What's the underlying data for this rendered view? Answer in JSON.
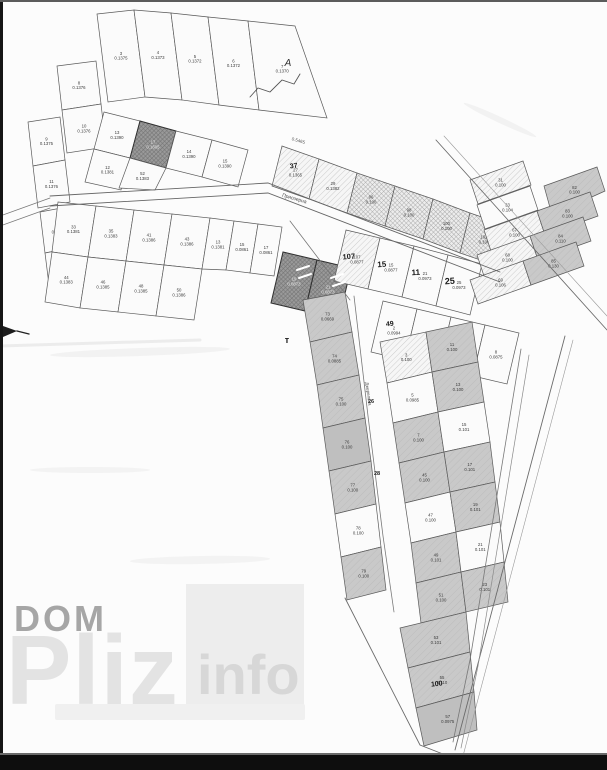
{
  "watermark": {
    "line1": "DOM",
    "line2": "Pliz",
    "line3": "info"
  },
  "map": {
    "street_main": "Приозерна",
    "street_side": "Джерельна",
    "junction_label": "А",
    "area_note": "0.5465",
    "t_mark": "т",
    "plot_font_size": 4.3,
    "colors": {
      "stroke": "#5a5a5a",
      "dark_stroke": "#2f2f2f",
      "label": "#3c3c3c",
      "label_dark": "#e8e8e8",
      "white": "#fbfbfb",
      "gray": "#c9c9c9",
      "gray2": "#bfbfbf"
    },
    "plots": [
      {
        "p": "97,14 134,10 145,97 108,102",
        "f": "w",
        "n": "3",
        "a": "0.1375"
      },
      {
        "p": "134,10 171,13 182,100 145,97",
        "f": "w",
        "n": "4",
        "a": "0.1373"
      },
      {
        "p": "171,13 208,17 219,105 182,100",
        "f": "w",
        "n": "5",
        "a": "0.1372"
      },
      {
        "p": "208,17 248,21 259,110 219,105",
        "f": "w",
        "n": "6",
        "a": "0.1372"
      },
      {
        "p": "248,21 295,26 327,118 259,110",
        "f": "w",
        "n": "7",
        "a": "0.1370"
      },
      {
        "p": "57,66 96,61 101,104 62,110",
        "f": "w",
        "n": "8",
        "a": "0.1376"
      },
      {
        "p": "62,110 101,104 106,147 67,153",
        "f": "w",
        "n": "10",
        "a": "0.1376"
      },
      {
        "p": "28,122 60,117 65,160 33,166",
        "f": "w",
        "n": "9",
        "a": "0.1375"
      },
      {
        "p": "33,166 65,160 70,202 38,208",
        "f": "w",
        "n": "11",
        "a": "0.1376"
      },
      {
        "p": "40,212 72,206 76,247 45,253",
        "f": "w",
        "n": "2",
        "a": "0.1379"
      },
      {
        "p": "45,253 76,247 80,287 50,293",
        "f": "w",
        "n": "4",
        "a": "0.1382"
      },
      {
        "p": "104,112 140,121 130,158 94,149",
        "f": "w",
        "n": "13",
        "a": "0.1390"
      },
      {
        "p": "140,121 176,131 166,168 130,158",
        "f": "d",
        "n": "17",
        "a": "0.1605"
      },
      {
        "p": "176,131 212,140 202,177 166,168",
        "f": "w",
        "n": "14",
        "a": "0.1390"
      },
      {
        "p": "212,140 248,150 238,187 202,177",
        "f": "w",
        "n": "15",
        "a": "0.1390"
      },
      {
        "p": "94,149 130,158 121,190 85,182",
        "f": "w",
        "n": "12",
        "a": "0.1381"
      },
      {
        "p": "130,158 166,168 155,190 119,188",
        "f": "w",
        "n": "52",
        "a": "0.1383"
      },
      {
        "p": "58,202 96,206 88,257 52,252",
        "f": "w",
        "n": "33",
        "a": "0.1381"
      },
      {
        "p": "96,206 134,210 126,261 88,257",
        "f": "w",
        "n": "35",
        "a": "0.1383"
      },
      {
        "p": "134,210 172,214 164,265 126,261",
        "f": "w",
        "n": "41",
        "a": "0.1386"
      },
      {
        "p": "172,214 210,218 202,269 164,265",
        "f": "w",
        "n": "43",
        "a": "0.1386"
      },
      {
        "p": "210,218 234,221 226,270 202,269",
        "f": "w",
        "n": "13",
        "a": "0.1381"
      },
      {
        "p": "234,221 258,224 250,273 226,270",
        "f": "w",
        "n": "15",
        "a": "0.0861"
      },
      {
        "p": "258,224 282,227 274,276 250,273",
        "f": "w",
        "n": "17",
        "a": "0.0861"
      },
      {
        "p": "52,252 88,257 80,308 45,302",
        "f": "w",
        "n": "44",
        "a": "0.1383"
      },
      {
        "p": "88,257 126,261 118,312 80,308",
        "f": "w",
        "n": "46",
        "a": "0.1385"
      },
      {
        "p": "126,261 164,265 156,316 118,312",
        "f": "w",
        "n": "48",
        "a": "0.1385"
      },
      {
        "p": "164,265 202,269 194,320 156,316",
        "f": "w",
        "n": "50",
        "a": "0.1386"
      },
      {
        "p": "282,146 319,159 309,199 272,186",
        "f": "hl",
        "n": "27",
        "a": "0.1365"
      },
      {
        "p": "319,159 357,173 347,213 309,199",
        "f": "hl",
        "n": "29",
        "a": "0.1382"
      },
      {
        "p": "357,173 395,186 385,226 347,213",
        "f": "hh",
        "n": "96",
        "a": "0.100"
      },
      {
        "p": "395,186 433,199 423,239 385,226",
        "f": "hh",
        "n": "98",
        "a": "0.100"
      },
      {
        "p": "433,199 470,213 460,253 423,239",
        "f": "hh",
        "n": "100",
        "a": "0.100"
      },
      {
        "p": "470,213 508,226 498,266 460,253",
        "f": "hh",
        "n": "102",
        "a": "0.100"
      },
      {
        "p": "283,252 317,260 305,311 271,303",
        "f": "d",
        "n": "19",
        "a": "0.0873"
      },
      {
        "p": "317,260 351,268 339,319 305,311",
        "f": "d",
        "n": "21",
        "a": "0.0873"
      },
      {
        "p": "346,230 380,238 368,289 334,281",
        "f": "hl",
        "n": "107",
        "a": "0.0877"
      },
      {
        "p": "380,238 414,246 402,297 368,289",
        "f": "w",
        "n": "15",
        "a": "0.0877"
      },
      {
        "p": "414,246 448,255 436,306 402,297",
        "f": "w",
        "n": "21",
        "a": "0.0973"
      },
      {
        "p": "448,255 482,264 470,315 436,306",
        "f": "w",
        "n": "25",
        "a": "0.0973"
      },
      {
        "p": "383,301 417,309 405,360 371,352",
        "f": "w",
        "n": "2",
        "a": "0.0994"
      },
      {
        "p": "417,309 451,317 439,368 405,360",
        "f": "w",
        "n": "4",
        "a": "0.0989"
      },
      {
        "p": "451,317 485,325 473,376 439,368",
        "f": "w",
        "n": "6",
        "a": "0.0875"
      },
      {
        "p": "485,325 519,333 507,384 473,376",
        "f": "w",
        "n": "8",
        "a": "0.0875"
      },
      {
        "p": "470,180 523,161 531,185 478,204",
        "f": "hl",
        "n": "31",
        "a": "0.100"
      },
      {
        "p": "477,205 530,186 538,210 485,229",
        "f": "w",
        "n": "33",
        "a": "0.104"
      },
      {
        "p": "484,230 537,211 545,235 492,254",
        "f": "hl",
        "n": "67",
        "a": "0.100"
      },
      {
        "p": "477,255 530,236 538,260 485,279",
        "f": "hl",
        "n": "68",
        "a": "0.100"
      },
      {
        "p": "470,280 523,261 531,285 478,304",
        "f": "hl",
        "n": "69",
        "a": "0.106"
      },
      {
        "p": "544,186 597,167 605,191 552,215",
        "f": "g",
        "n": "82",
        "a": "0.100"
      },
      {
        "p": "537,211 590,192 598,216 545,235",
        "f": "g",
        "n": "83",
        "a": "0.100"
      },
      {
        "p": "530,236 583,217 591,241 538,260",
        "f": "g",
        "n": "84",
        "a": "0.110"
      },
      {
        "p": "523,261 576,242 584,266 531,285",
        "f": "g",
        "n": "85",
        "a": "0.130"
      },
      {
        "p": "303,300 345,292 352,332 310,342",
        "f": "g",
        "n": "73",
        "a": "0.0669"
      },
      {
        "p": "310,342 352,332 359,375 317,385",
        "f": "g",
        "n": "74",
        "a": "0.0885"
      },
      {
        "p": "317,385 359,375 365,418 323,428",
        "f": "g",
        "n": "75",
        "a": "0.100"
      },
      {
        "p": "323,428 365,418 371,461 329,471",
        "f": "g2",
        "n": "76",
        "a": "0.100"
      },
      {
        "p": "329,471 371,461 376,504 335,514",
        "f": "g",
        "n": "77",
        "a": "0.100"
      },
      {
        "p": "335,514 376,504 381,547 341,557",
        "f": "w",
        "n": "78",
        "a": "0.100"
      },
      {
        "p": "341,557 381,547 386,590 347,600",
        "f": "g",
        "n": "79",
        "a": "0.100"
      },
      {
        "p": "380,342 426,332 432,372 387,383",
        "f": "hl",
        "n": "3",
        "a": "0.100"
      },
      {
        "p": "387,383 432,372 438,412 393,423",
        "f": "w",
        "n": "5",
        "a": "0.0985"
      },
      {
        "p": "393,423 438,412 444,452 399,463",
        "f": "g",
        "n": "7",
        "a": "0.100"
      },
      {
        "p": "399,463 444,452 450,492 405,503",
        "f": "g",
        "n": "45",
        "a": "0.100"
      },
      {
        "p": "405,503 450,492 456,532 411,543",
        "f": "w",
        "n": "47",
        "a": "0.100"
      },
      {
        "p": "411,543 456,532 461,572 416,583",
        "f": "g",
        "n": "49",
        "a": "0.101"
      },
      {
        "p": "416,583 461,572 466,612 421,623",
        "f": "g",
        "n": "51",
        "a": "0.100"
      },
      {
        "p": "426,332 472,322 478,362 432,372",
        "f": "g",
        "n": "11",
        "a": "0.100"
      },
      {
        "p": "432,372 478,362 484,402 438,412",
        "f": "g",
        "n": "13",
        "a": "0.100"
      },
      {
        "p": "438,412 484,402 490,442 444,452",
        "f": "w",
        "n": "15",
        "a": "0.101"
      },
      {
        "p": "444,452 490,442 495,482 450,492",
        "f": "g",
        "n": "17",
        "a": "0.101"
      },
      {
        "p": "450,492 495,482 500,522 456,532",
        "f": "g",
        "n": "19",
        "a": "0.101"
      },
      {
        "p": "456,532 500,522 504,562 461,572",
        "f": "w",
        "n": "21",
        "a": "0.101"
      },
      {
        "p": "461,572 504,562 508,602 466,612",
        "f": "g",
        "n": "23",
        "a": "0.101"
      },
      {
        "p": "400,628 466,612 470,652 408,668",
        "f": "g",
        "n": "53",
        "a": "0.101"
      },
      {
        "p": "408,668 470,652 474,692 416,708",
        "f": "g",
        "n": "55",
        "a": "0.110"
      },
      {
        "p": "416,708 474,692 477,730 424,746",
        "f": "g2",
        "n": "57",
        "a": "0.0975"
      }
    ],
    "arrow": "3,326 17,331 3,337",
    "lines": [
      {
        "p": "50,196 268,183 500,272",
        "w": 0.9,
        "c": "#666666"
      },
      {
        "p": "50,206 268,193 500,282",
        "w": 0.9,
        "c": "#666666"
      },
      {
        "p": "0,216 50,198",
        "w": 0.8,
        "c": "#777777"
      },
      {
        "p": "0,226 50,208",
        "w": 0.8,
        "c": "#777777"
      },
      {
        "p": "436,140 607,330",
        "w": 0.9,
        "c": "#6b6b6b"
      },
      {
        "p": "444,136 607,316",
        "w": 0.6,
        "c": "#9a9a9a"
      },
      {
        "p": "345,598 420,745 448,756",
        "w": 0.9,
        "c": "#6b6b6b"
      },
      {
        "p": "565,336 455,750",
        "w": 0.9,
        "c": "#6b6b6b"
      },
      {
        "p": "573,340 463,756",
        "w": 0.6,
        "c": "#9a9a9a"
      },
      {
        "p": "354,296 368,416 383,536 394,612",
        "w": 0.8,
        "c": "#787878"
      },
      {
        "p": "521,349 470,660 453,742",
        "w": 0.8,
        "c": "#787878"
      },
      {
        "p": "529,355 478,666 461,748",
        "w": 0.7,
        "c": "#8a8a8a"
      },
      {
        "p": "290,221 350,300",
        "w": 0.8,
        "c": "#777777"
      },
      {
        "p": "250,97 258,88 270,92 282,80 294,84 300,74",
        "w": 0.9,
        "c": "#555555"
      },
      {
        "p": "297,270 309,266",
        "w": 2,
        "c": "#ffffff"
      },
      {
        "p": "299,278 311,274",
        "w": 2,
        "c": "#ffffff"
      },
      {
        "p": "331,278 343,274",
        "w": 2,
        "c": "#ffffff"
      },
      {
        "p": "333,286 345,282",
        "w": 2,
        "c": "#ffffff"
      },
      {
        "p": "0,346 200,340",
        "w": 3,
        "c": "#ececec"
      },
      {
        "p": "17,331 29,334",
        "w": 1.4,
        "c": "#222222"
      }
    ],
    "labels": [
      {
        "x": 288,
        "y": 66,
        "t": "А",
        "fs": 10,
        "rot": 0,
        "c": "#333333",
        "b": 0,
        "i": 1
      },
      {
        "x": 298,
        "y": 142,
        "t": "0.5465",
        "fs": 4.5,
        "rot": 16,
        "c": "#555555",
        "b": 0
      },
      {
        "x": 294,
        "y": 200,
        "t": "Приозерна",
        "fs": 5,
        "rot": 16,
        "c": "#454545",
        "b": 0
      },
      {
        "x": 367,
        "y": 394,
        "t": "Джерельна",
        "fs": 4.5,
        "rot": 82,
        "c": "#4a4a4a",
        "b": 0
      },
      {
        "x": 287,
        "y": 343,
        "t": "т",
        "fs": 9,
        "rot": 0,
        "c": "#222222",
        "b": 1
      },
      {
        "x": 294,
        "y": 168,
        "t": "37",
        "fs": 7,
        "rot": -8,
        "c": "#1a1a1a",
        "b": 1
      },
      {
        "x": 349,
        "y": 259,
        "t": "107",
        "fs": 7.5,
        "rot": -5,
        "c": "#1a1a1a",
        "b": 1
      },
      {
        "x": 382,
        "y": 267,
        "t": "15",
        "fs": 8,
        "rot": -4,
        "c": "#1a1a1a",
        "b": 1
      },
      {
        "x": 416,
        "y": 275,
        "t": "11",
        "fs": 8,
        "rot": -4,
        "c": "#1a1a1a",
        "b": 1
      },
      {
        "x": 450,
        "y": 284,
        "t": "25",
        "fs": 9,
        "rot": -4,
        "c": "#1a1a1a",
        "b": 1
      },
      {
        "x": 390,
        "y": 326,
        "t": "49",
        "fs": 7,
        "rot": -6,
        "c": "#1a1a1a",
        "b": 1
      },
      {
        "x": 437,
        "y": 686,
        "t": "100",
        "fs": 7,
        "rot": -6,
        "c": "#1a1a1a",
        "b": 1
      },
      {
        "x": 371,
        "y": 403,
        "t": "26",
        "fs": 5.5,
        "rot": 0,
        "c": "#222222",
        "b": 1
      },
      {
        "x": 377,
        "y": 475,
        "t": "28",
        "fs": 5.5,
        "rot": 0,
        "c": "#222222",
        "b": 1
      }
    ],
    "blobs": [
      {
        "x": 140,
        "y": 352,
        "rx": 90,
        "ry": 4,
        "rot": -2,
        "c": "#f1f1f1"
      },
      {
        "x": 90,
        "y": 470,
        "rx": 60,
        "ry": 3,
        "rot": 0,
        "c": "#f2f2f2"
      },
      {
        "x": 500,
        "y": 120,
        "rx": 40,
        "ry": 3,
        "rot": 25,
        "c": "#f1f1f1"
      },
      {
        "x": 200,
        "y": 560,
        "rx": 70,
        "ry": 4,
        "rot": -1,
        "c": "#f2f2f2"
      }
    ]
  }
}
